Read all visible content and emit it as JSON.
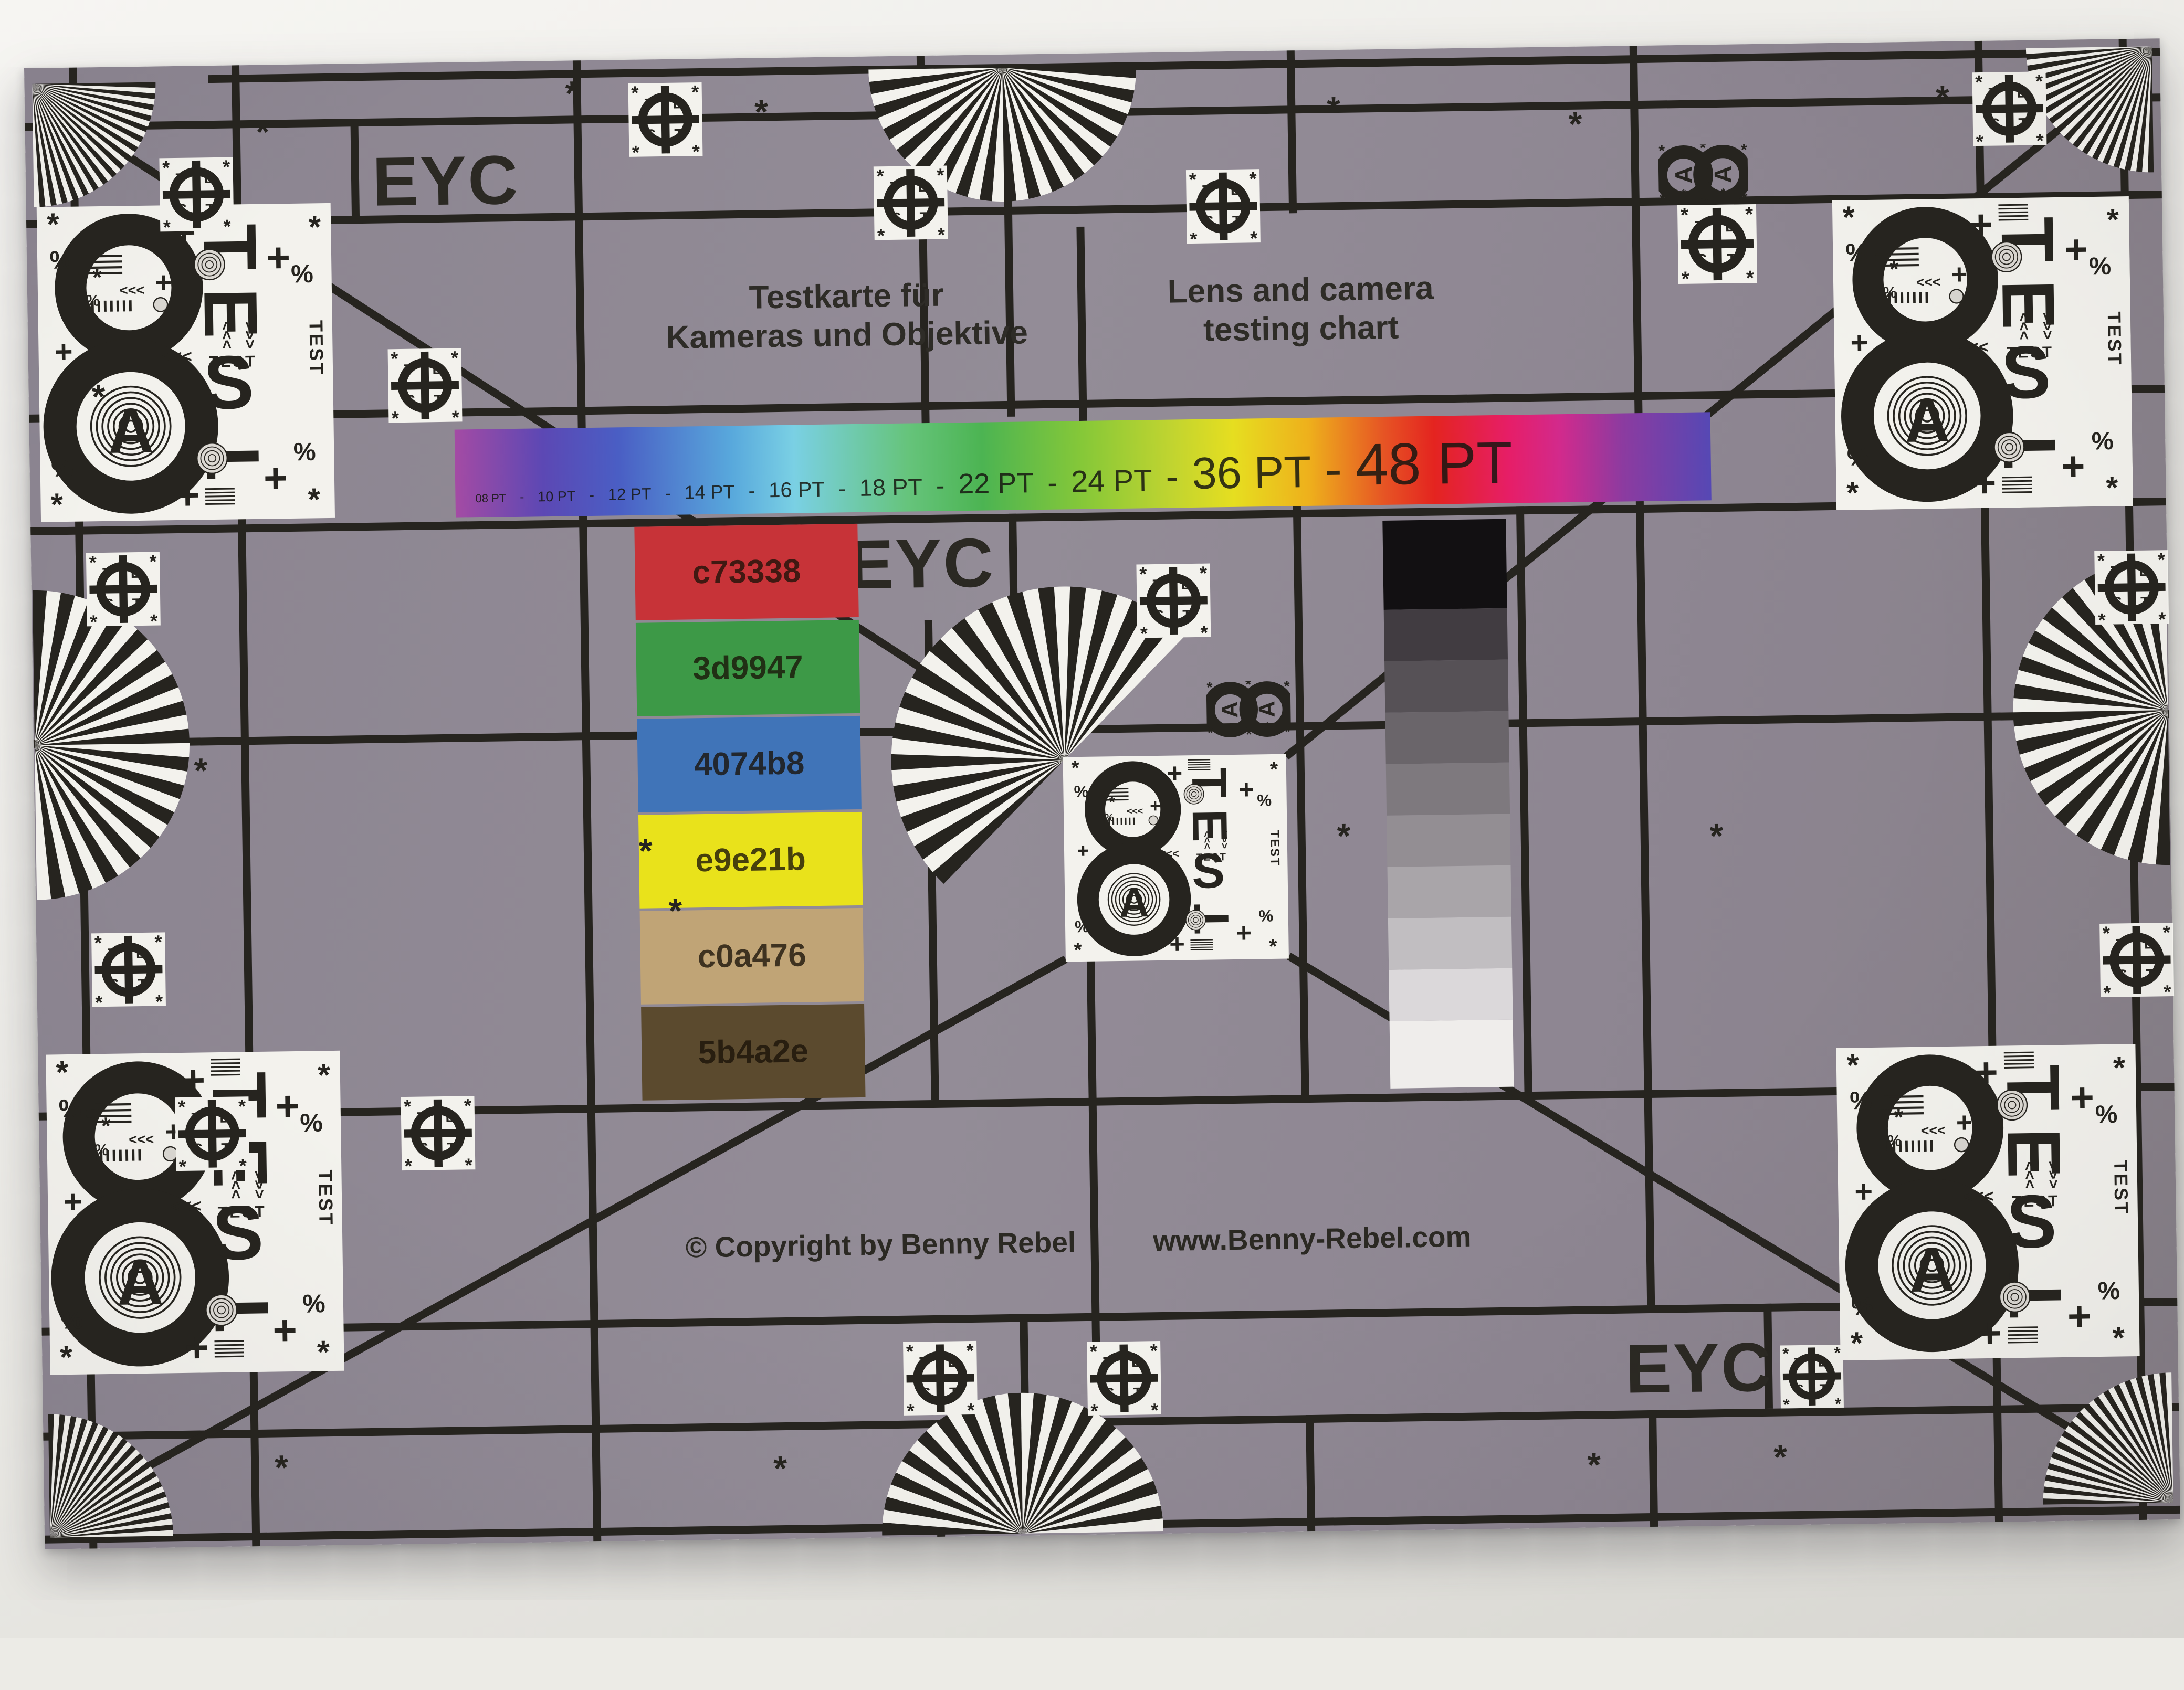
{
  "titles": {
    "de_line1": "Testkarte für",
    "de_line2": "Kameras und Objektive",
    "en_line1": "Lens and camera",
    "en_line2": "testing chart"
  },
  "eyc_label": "EYC",
  "footer": {
    "copyright": "© Copyright by Benny Rebel",
    "website": "www.Benny-Rebel.com"
  },
  "pt_scale": {
    "items": [
      {
        "text": "08 PT",
        "pt": 8
      },
      {
        "text": "-",
        "pt": 9
      },
      {
        "text": "10 PT",
        "pt": 10
      },
      {
        "text": "-",
        "pt": 11
      },
      {
        "text": "12 PT",
        "pt": 12
      },
      {
        "text": "-",
        "pt": 13
      },
      {
        "text": "14 PT",
        "pt": 14
      },
      {
        "text": "-",
        "pt": 15
      },
      {
        "text": "16 PT",
        "pt": 16
      },
      {
        "text": "-",
        "pt": 17
      },
      {
        "text": "18 PT",
        "pt": 18
      },
      {
        "text": "-",
        "pt": 20
      },
      {
        "text": "22 PT",
        "pt": 22
      },
      {
        "text": "-",
        "pt": 23
      },
      {
        "text": "24 PT",
        "pt": 24
      },
      {
        "text": "-",
        "pt": 30
      },
      {
        "text": "36 PT",
        "pt": 36
      },
      {
        "text": "-",
        "pt": 42
      },
      {
        "text": "48 PT",
        "pt": 48
      }
    ]
  },
  "color_patches": {
    "items": [
      {
        "hex": "c73338"
      },
      {
        "hex": "3d9947"
      },
      {
        "hex": "4074b8"
      },
      {
        "hex": "e9e21b"
      },
      {
        "hex": "c0a476"
      },
      {
        "hex": "5b4a2e"
      }
    ]
  },
  "grayscale": {
    "steps": [
      "#121012",
      "#413c41",
      "#565156",
      "#6a656a",
      "#7e797e",
      "#938e93",
      "#a9a5a9",
      "#c1bec1",
      "#dbd8da",
      "#efedeb"
    ]
  },
  "marker": {
    "letters": [
      "T",
      "E",
      "S",
      "T"
    ],
    "star": "*"
  },
  "glyphs": {
    "eight": "8",
    "letter_a": "A",
    "test_word": "TEST",
    "percent": "%",
    "star": "*",
    "plus": "+",
    "arrows_left": "<<<"
  },
  "colors": {
    "chart_bg": "#8d8591",
    "ink": "#26241f",
    "panel_white": "#f3f2ed",
    "paper": "#ecebe6"
  }
}
